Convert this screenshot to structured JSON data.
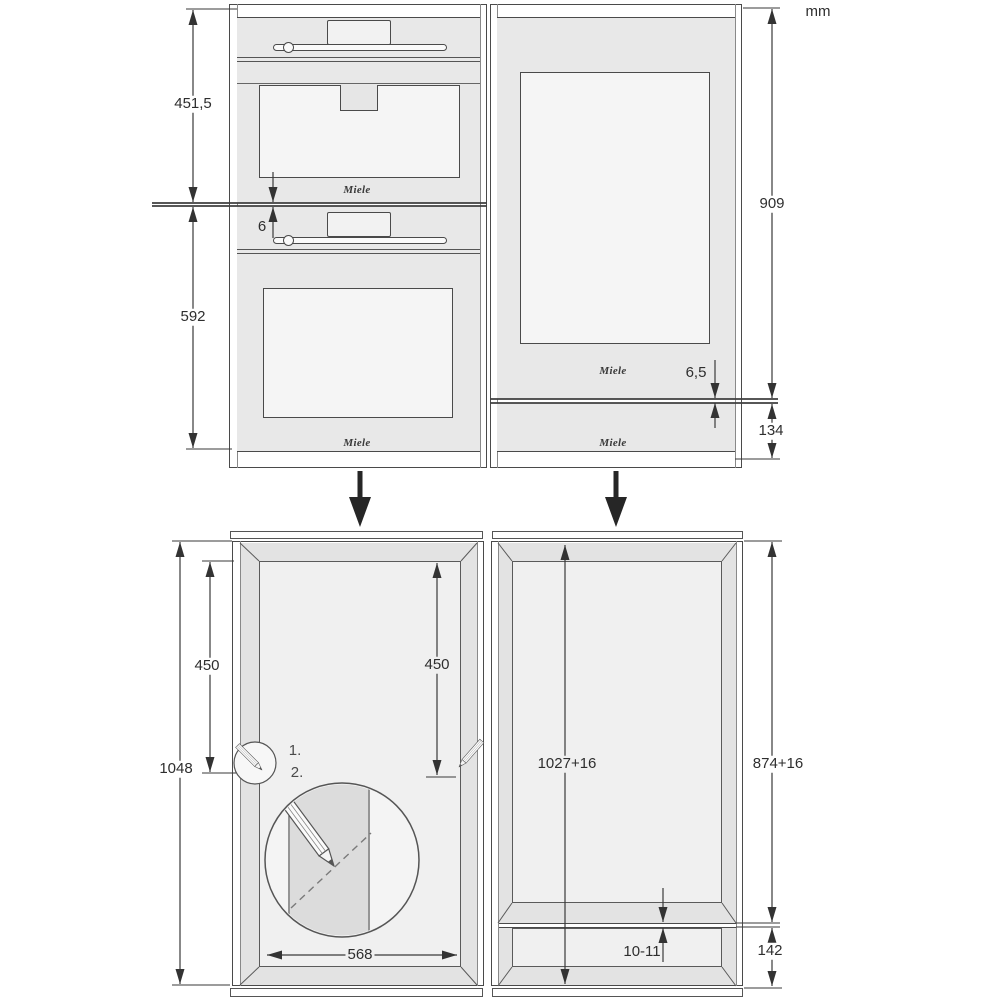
{
  "unit_label": "mm",
  "brand": "Miele",
  "front_view": {
    "left_stack": {
      "upper_appliance_height": "451,5",
      "gap": "6",
      "lower_appliance_height": "592"
    },
    "right_stack": {
      "appliance_height": "909",
      "gap": "6,5",
      "lower_panel_height": "134"
    }
  },
  "installation_view": {
    "left_niche": {
      "total_height": "1048",
      "marking_height_left": "450",
      "marking_height_right": "450",
      "niche_width": "568",
      "step_labels": [
        "1.",
        "2."
      ]
    },
    "right_niche": {
      "full_inner_height": "1027+16",
      "upper_niche_height": "874+16",
      "shelf_thickness": "10-11",
      "plinth_height": "142"
    }
  }
}
